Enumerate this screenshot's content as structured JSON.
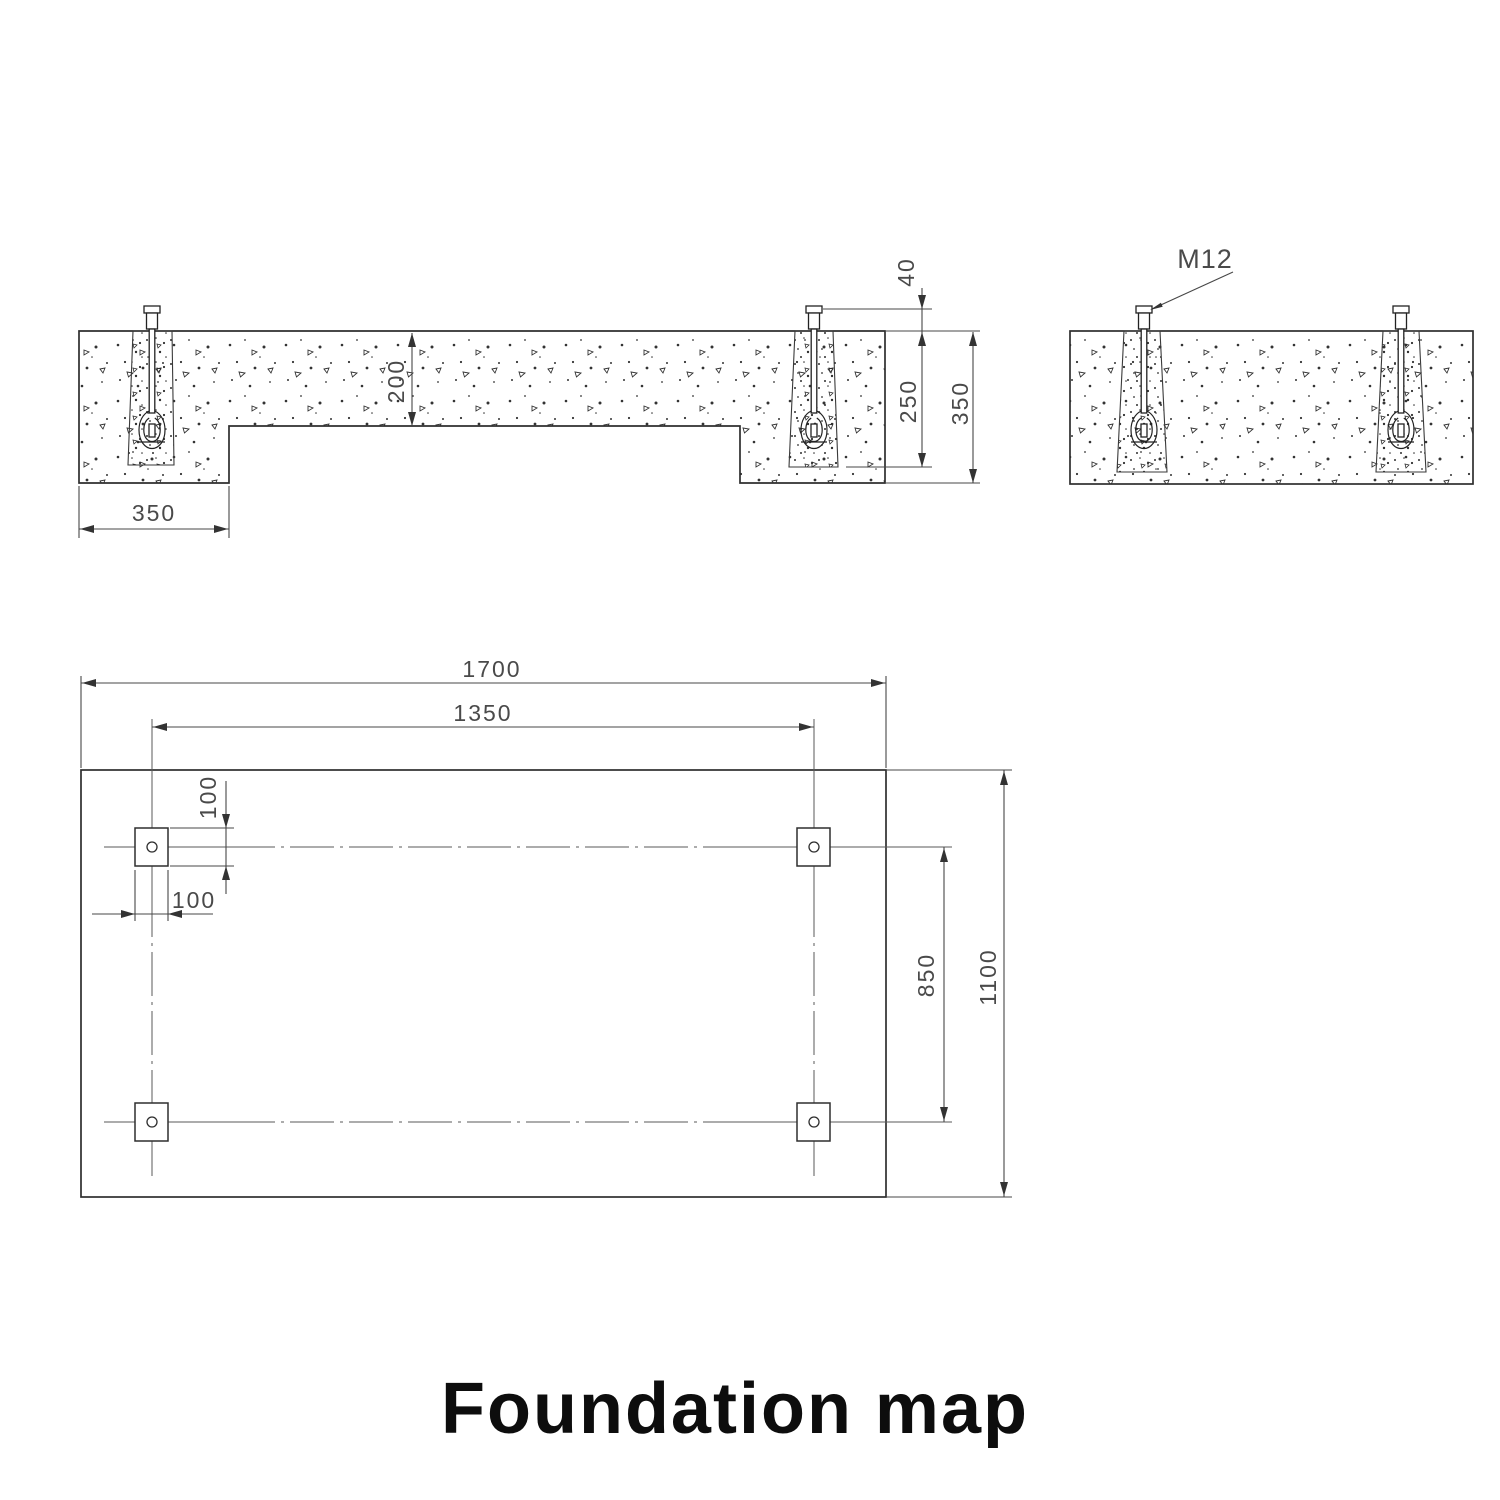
{
  "title": "Foundation map",
  "front_section": {
    "pier_width": "350",
    "slab_thickness": "200",
    "bolt_projection": "40",
    "pocket_depth": "250",
    "pier_depth": "350"
  },
  "side_section": {
    "bolt_label": "M12"
  },
  "plan_view": {
    "overall_length": "1700",
    "bolt_spacing_length": "1350",
    "pocket_height": "100",
    "pocket_width": "100",
    "bolt_spacing_width": "850",
    "overall_width": "1100"
  }
}
